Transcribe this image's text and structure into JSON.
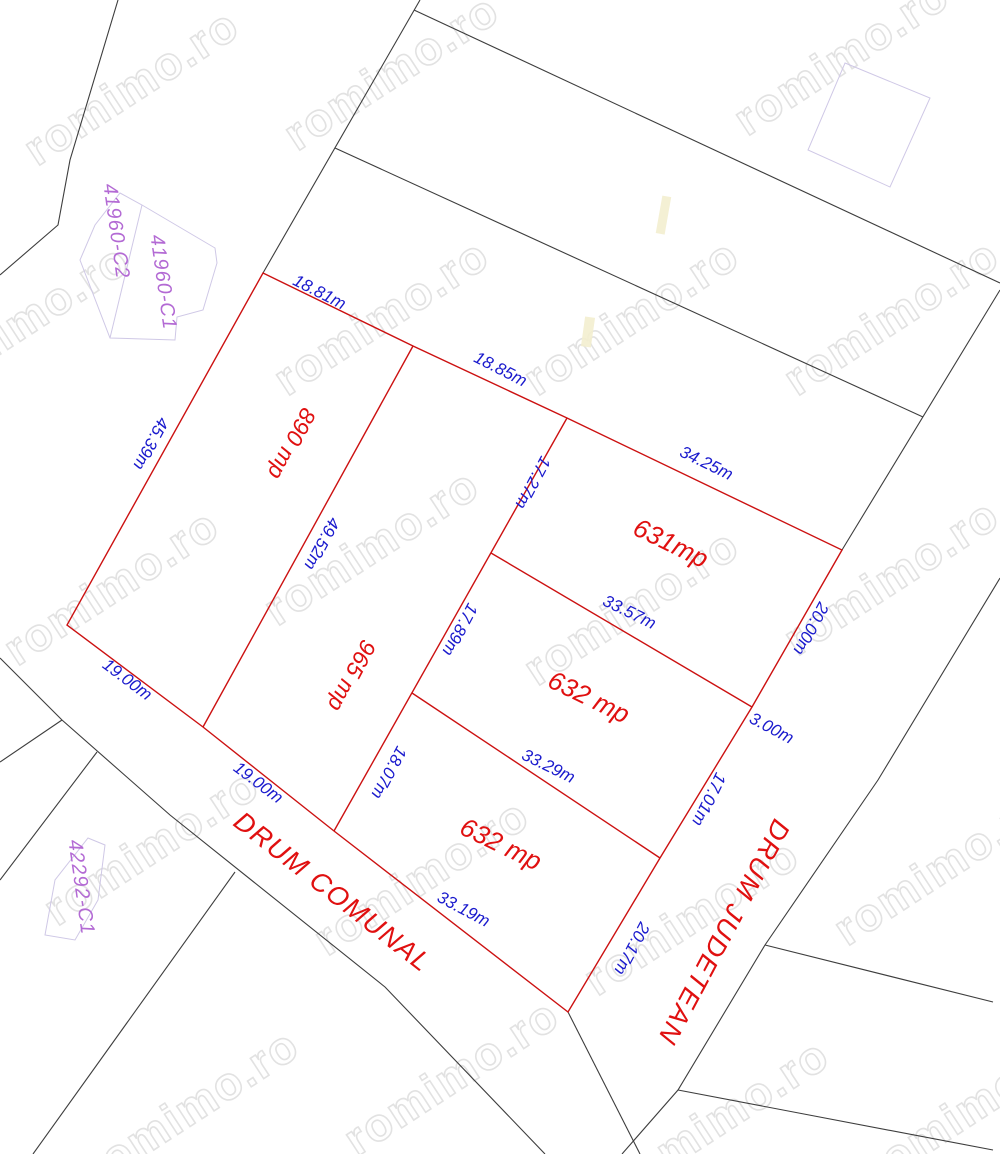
{
  "watermark": {
    "text": "romimo.ro"
  },
  "cadastral": {
    "c41960_c2": "41960-C2",
    "c41960_c1": "41960-C1",
    "c42292_c1": "42292-C1"
  },
  "areas": {
    "p890": "890 mp",
    "p965": "965 mp",
    "p631": "631mp",
    "p632_mid": "632 mp",
    "p632_bot": "632 mp"
  },
  "dims": {
    "d18_81": "18.81m",
    "d18_85": "18.85m",
    "d34_25": "34.25m",
    "d45_39": "45.39m",
    "d49_52": "49.52m",
    "d17_27": "17.27m",
    "d17_89": "17.89m",
    "d18_07": "18.07m",
    "d33_57": "33.57m",
    "d33_29": "33.29m",
    "d33_19": "33.19m",
    "d20_00": "20.00m",
    "d3_00": "3.00m",
    "d17_01": "17.01m",
    "d20_17": "20.17m",
    "d19_00_a": "19.00m",
    "d19_00_b": "19.00m"
  },
  "roads": {
    "comunal": "DRUM COMUNAL",
    "judetean": "DRUM JUDETEAN"
  },
  "colors": {
    "parcel_boundary_red": "#cc1111",
    "dimension_blue": "#1a1acd",
    "cadastral_purple": "#b36ad4",
    "neighbor_line_black": "#3d3d3d",
    "building_outline_lavender": "#cfc8e6",
    "watermark_gray": "#dddddd"
  }
}
